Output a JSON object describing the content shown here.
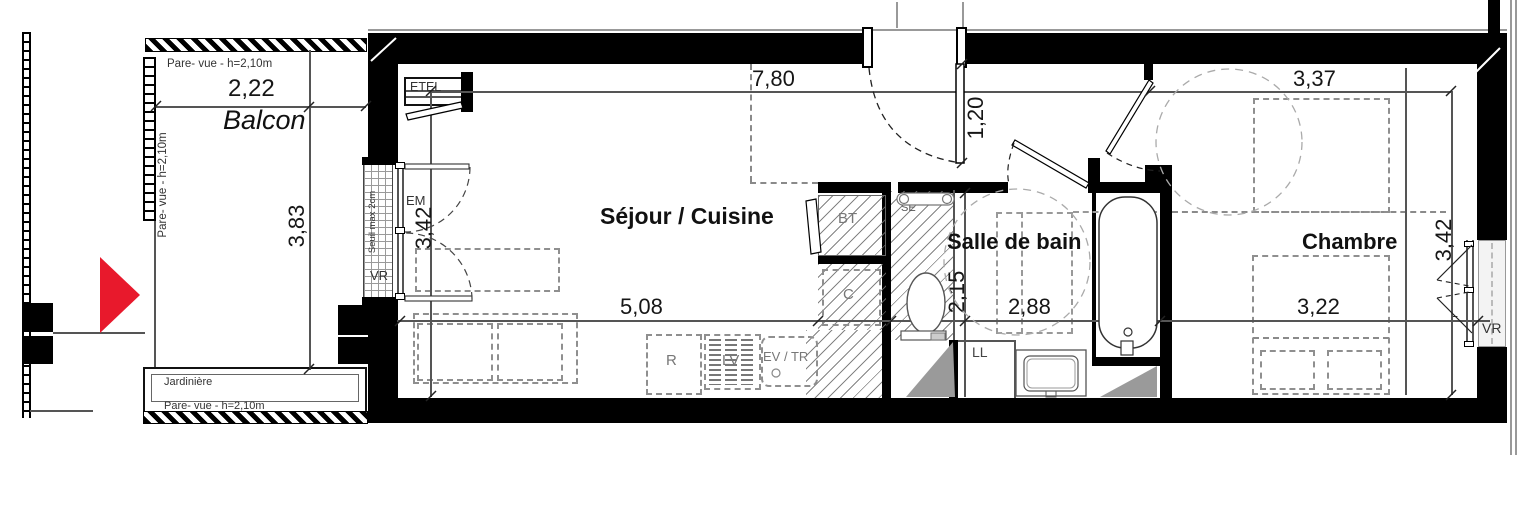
{
  "colors": {
    "wall": "#000000",
    "entrance_arrow_red": "#e8192c",
    "dash_gray": "#8f8f8f",
    "fixture_gray": "#9a9a9a"
  },
  "rooms": {
    "balcony": {
      "label": "Balcon"
    },
    "living": {
      "label": "Séjour / Cuisine"
    },
    "bathroom": {
      "label": "Salle de bain"
    },
    "bedroom": {
      "label": "Chambre"
    }
  },
  "dims": {
    "balcony_width": "2,22",
    "balcony_depth": "3,83",
    "living_width": "7,80",
    "living_depth": "3,42",
    "entry_recess": "1,20",
    "kitchen_run": "5,08",
    "bathroom_depth": "2,15",
    "bathroom_width": "2,88",
    "bedroom_width": "3,37",
    "bedroom_depth": "3,42",
    "bed_wall": "3,22"
  },
  "ann": {
    "pare_vue_top": "Pare- vue - h=2,10m",
    "pare_vue_left": "Pare- vue - h=2,10m",
    "pare_vue_bottom": "Pare- vue - h=2,10m",
    "jardiniere": "Jardinière",
    "seuil_max": "Seuil max 2cm",
    "etel": "ETEL",
    "em": "EM",
    "vr_living_window": "VR",
    "bt": "BT",
    "se": "SE",
    "cooktop": "C",
    "fridge": "R",
    "dishwasher": "LV",
    "sink_waste": "EV / TR",
    "washer": "LL",
    "window_f": "F",
    "vr_bedroom_window": "VR"
  }
}
